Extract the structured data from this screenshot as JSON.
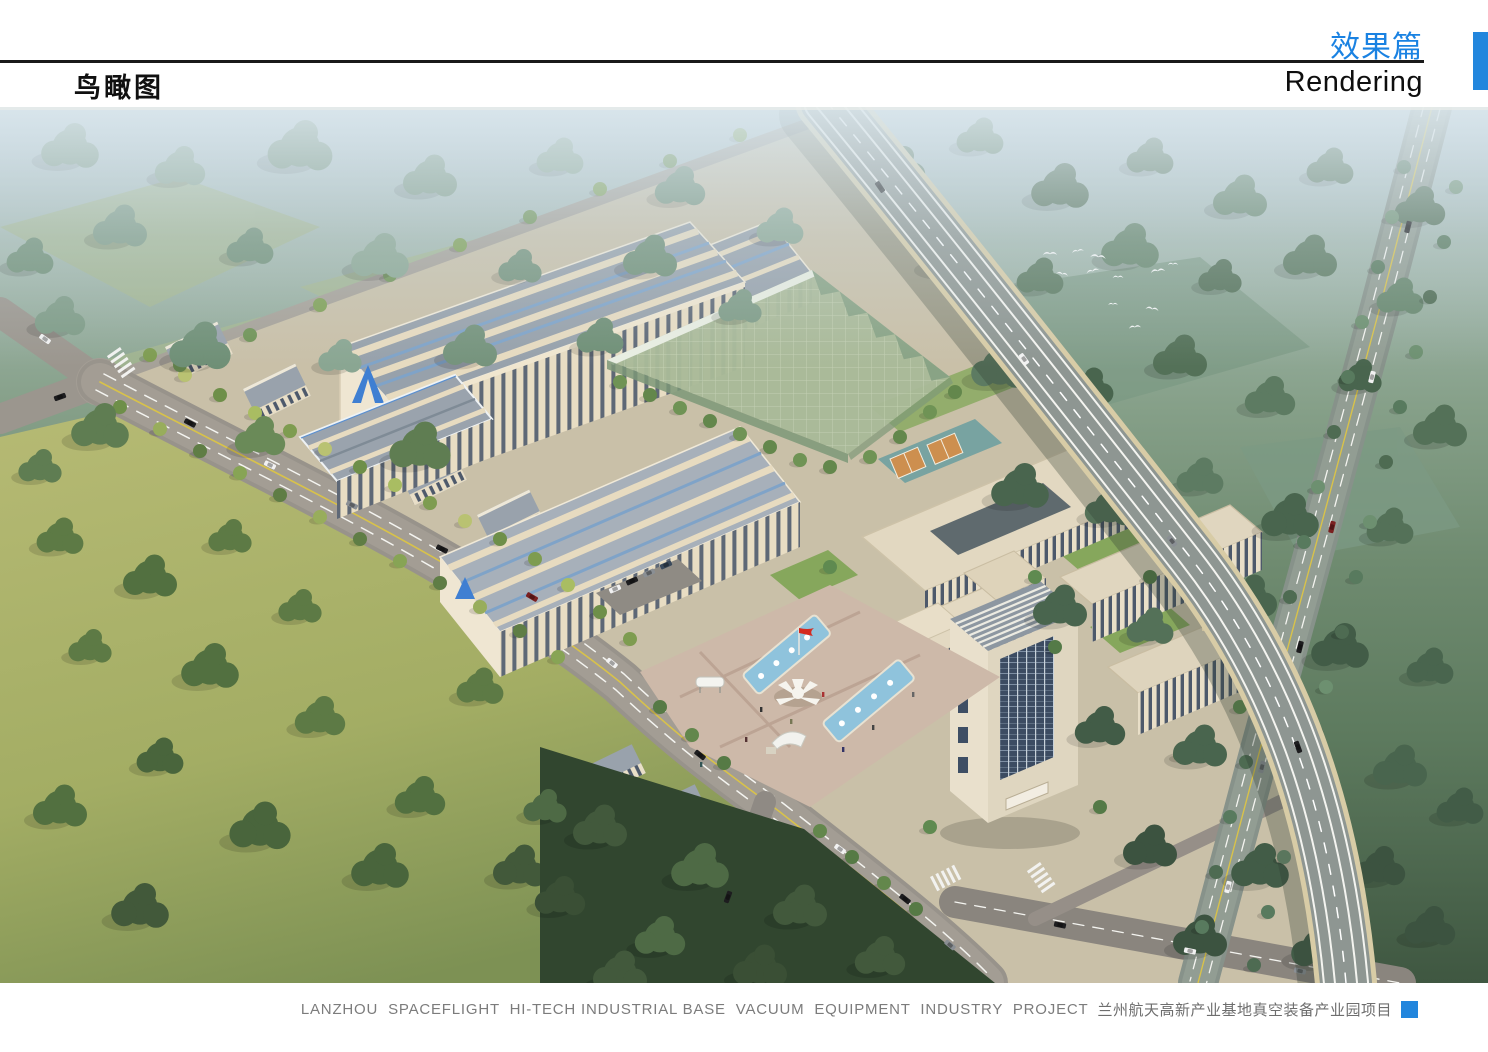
{
  "header": {
    "section_title_zh": "效果篇",
    "section_title_en": "Rendering",
    "page_title_zh": "鸟瞰图"
  },
  "footer": {
    "caption_en": "LANZHOU  SPACEFLIGHT  HI-TECH INDUSTRIAL BASE  VACUUM  EQUIPMENT  INDUSTRY  PROJECT",
    "caption_zh": "兰州航天高新产业基地真空装备产业园项目"
  },
  "colors": {
    "accent_blue": "#1a82e2",
    "tab_blue": "#2286dd",
    "caption_gray": "#7c7c7c",
    "rule_black": "#191919"
  },
  "rendering": {
    "description": "Aerial bird's-eye rendering of an industrial park: striped-roof factory halls with a blue arrow logo, a green glass workshop, courtyard office buildings, a fountain plaza with red flag, a dormitory tower, tree-lined boulevards, an elevated expressway crossing woodland, flying egrets and surrounding fields."
  }
}
